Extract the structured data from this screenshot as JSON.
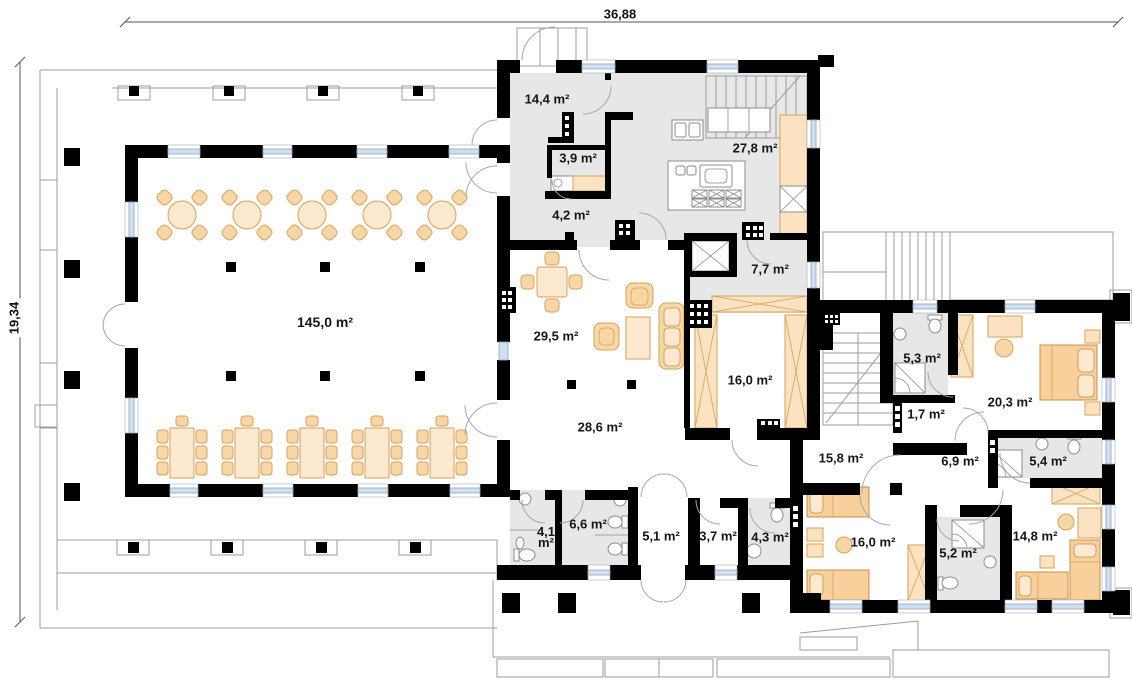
{
  "drawing": {
    "type": "architectural-floor-plan",
    "overall_dimensions": {
      "top": "36,88",
      "left": "19,34"
    }
  },
  "rooms": [
    {
      "id": "hall",
      "area": "145,0 m²"
    },
    {
      "id": "entry-hall",
      "area": "14,4 m²"
    },
    {
      "id": "toilet-entry",
      "area": "3,9 m²"
    },
    {
      "id": "corridor-entry",
      "area": "4,2 m²"
    },
    {
      "id": "kitchen",
      "area": "27,8 m²"
    },
    {
      "id": "lift-lobby",
      "area": "7,7 m²"
    },
    {
      "id": "lounge",
      "area": "29,5 m²"
    },
    {
      "id": "storage-room",
      "area": "16,0 m²"
    },
    {
      "id": "corridor-main",
      "area": "28,6 m²"
    },
    {
      "id": "bathroom-north",
      "area": "5,3 m²"
    },
    {
      "id": "closet",
      "area": "1,7 m²"
    },
    {
      "id": "bedroom-east",
      "area": "20,3 m²"
    },
    {
      "id": "corridor-stairs",
      "area": "15,8 m²"
    },
    {
      "id": "corridor-bedrooms",
      "area": "6,9 m²"
    },
    {
      "id": "bathroom-east",
      "area": "5,4 m²"
    },
    {
      "id": "wc-small",
      "area": "4,1 m²"
    },
    {
      "id": "wc-large",
      "area": "6,6 m²"
    },
    {
      "id": "vestibule",
      "area": "5,1 m²"
    },
    {
      "id": "storage-small",
      "area": "3,7 m²"
    },
    {
      "id": "bathroom-staff",
      "area": "4,3 m²"
    },
    {
      "id": "bedroom-southwest",
      "area": "16,0 m²"
    },
    {
      "id": "bathroom-south",
      "area": "5,2 m²"
    },
    {
      "id": "bedroom-southeast",
      "area": "14,8 m²"
    }
  ],
  "colors": {
    "wall": "#000000",
    "floor_gray": "#e7e7e7",
    "furniture": "#f8d7a6",
    "furniture_light": "#fce9cf",
    "window_glass": "#cfe0f2",
    "outline": "#9c9c9c"
  }
}
